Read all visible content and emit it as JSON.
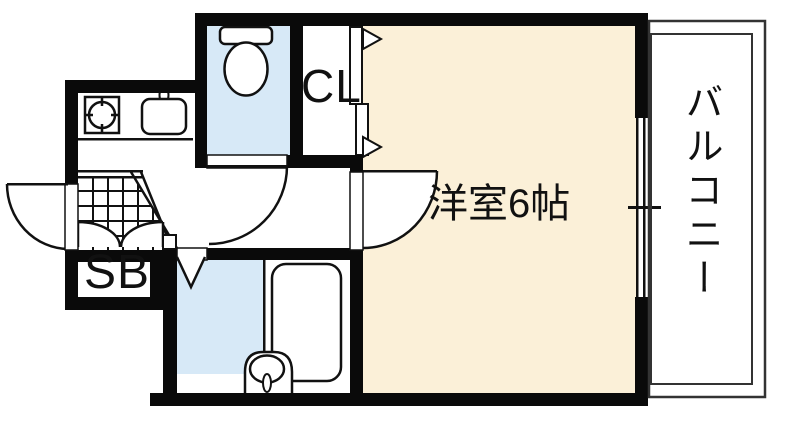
{
  "floorplan": {
    "rooms": {
      "main_room": {
        "label": "洋室6帖"
      },
      "closet": {
        "label": "CL"
      },
      "shoe_box": {
        "label": "SB"
      },
      "balcony": {
        "label": "バルコニー"
      }
    },
    "colors": {
      "wall": "#0a0a0a",
      "line": "#111111",
      "room_floor": "#FBF0D8",
      "wet_area_floor": "#D7E9F7",
      "background": "#ffffff"
    }
  }
}
